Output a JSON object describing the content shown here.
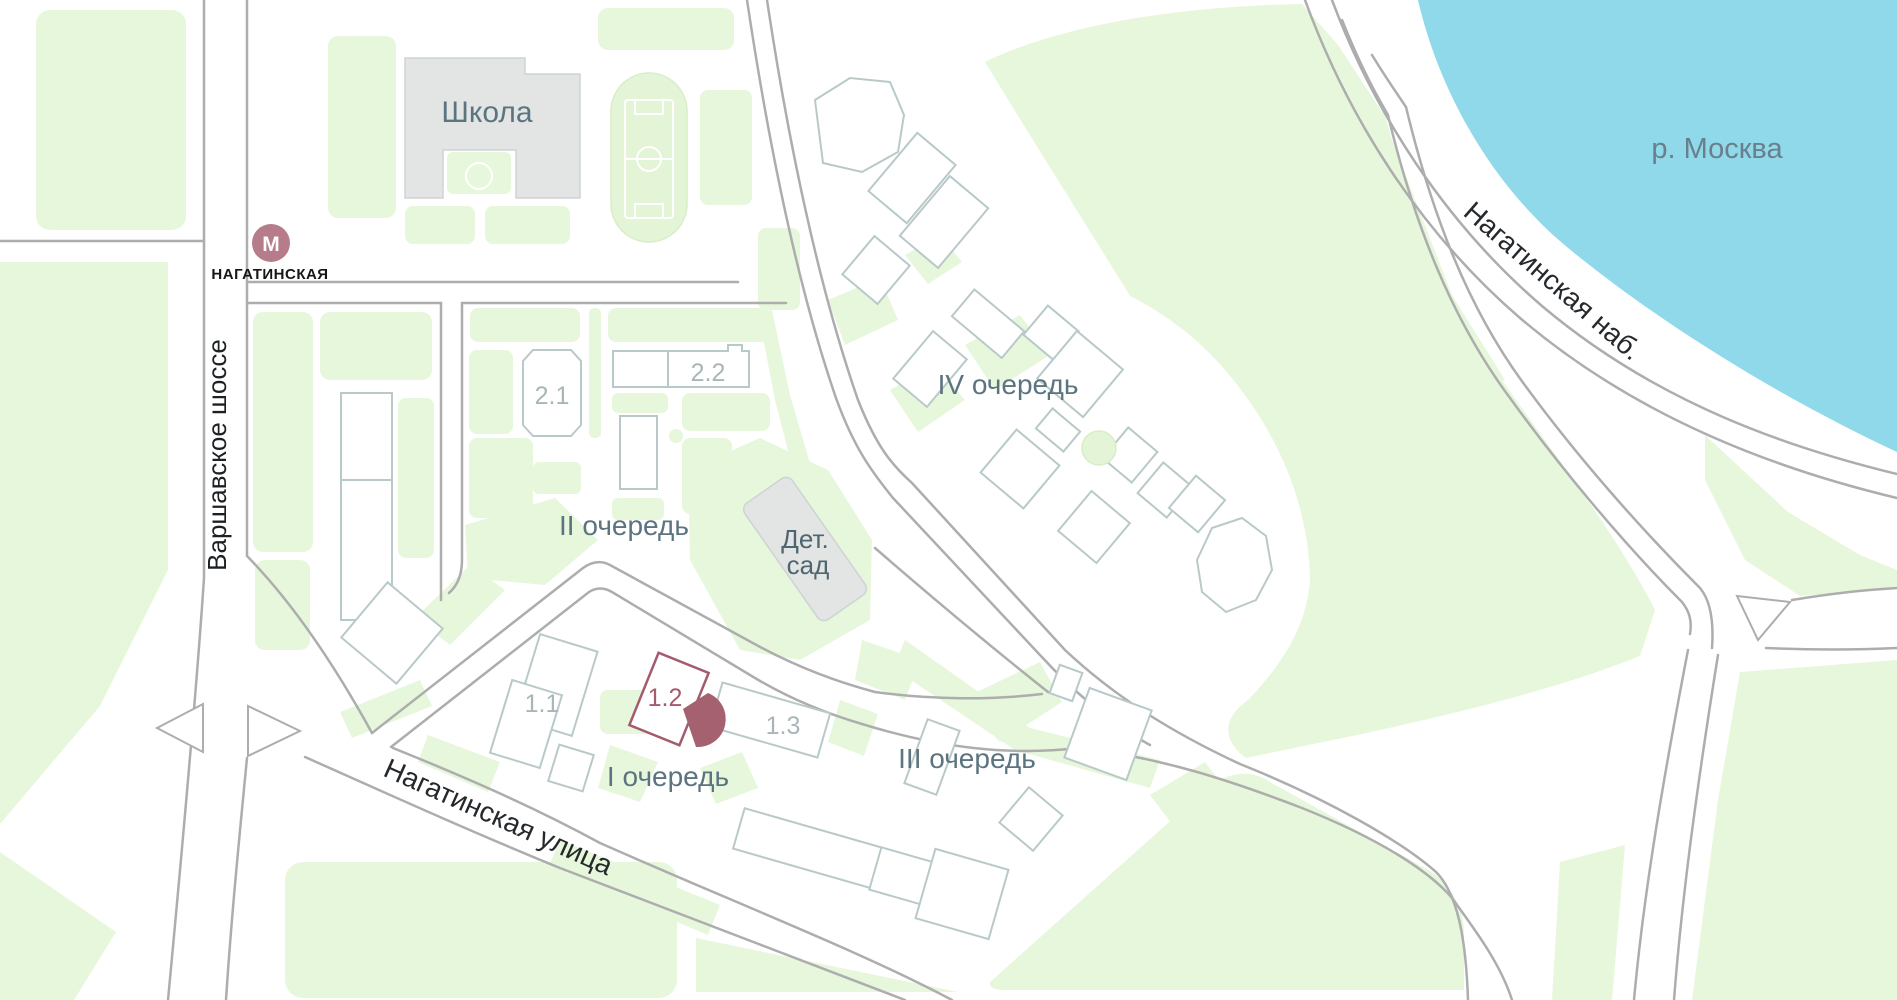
{
  "labels": {
    "school": "Школа",
    "metro_letter": "М",
    "metro_station": "НАГАТИНСКАЯ",
    "varshavskoe_shosse": "Варшавское шоссе",
    "nagatinskaya_ulitsa": "Нагатинская улица",
    "nagatinskaya_nab": "Нагатинская наб.",
    "river": "р. Москва",
    "kindergarten_line1": "Дет.",
    "kindergarten_line2": "сад",
    "phase_1": "I очередь",
    "phase_2": "II очередь",
    "phase_3": "III очередь",
    "phase_4": "IV очередь",
    "bld_1_1": "1.1",
    "bld_1_2": "1.2",
    "bld_1_3": "1.3",
    "bld_2_1": "2.1",
    "bld_2_2": "2.2"
  },
  "icons": {
    "metro": "metro-icon",
    "marker": "view-sector-marker-icon"
  },
  "colors": {
    "water": "#8fd9ea",
    "greenery": "#e7f7dc",
    "road_casing": "#adadad",
    "building_outline": "#b9c9c9",
    "building_gray_fill": "#e3e4e4",
    "highlight_building": "#a45b6d",
    "marker": "#a5616f",
    "metro": "#b67c8a",
    "phase_label": "#5b7480",
    "street_label": "#26292c",
    "river_label": "#69808c",
    "number_label": "#a9b6b8"
  }
}
